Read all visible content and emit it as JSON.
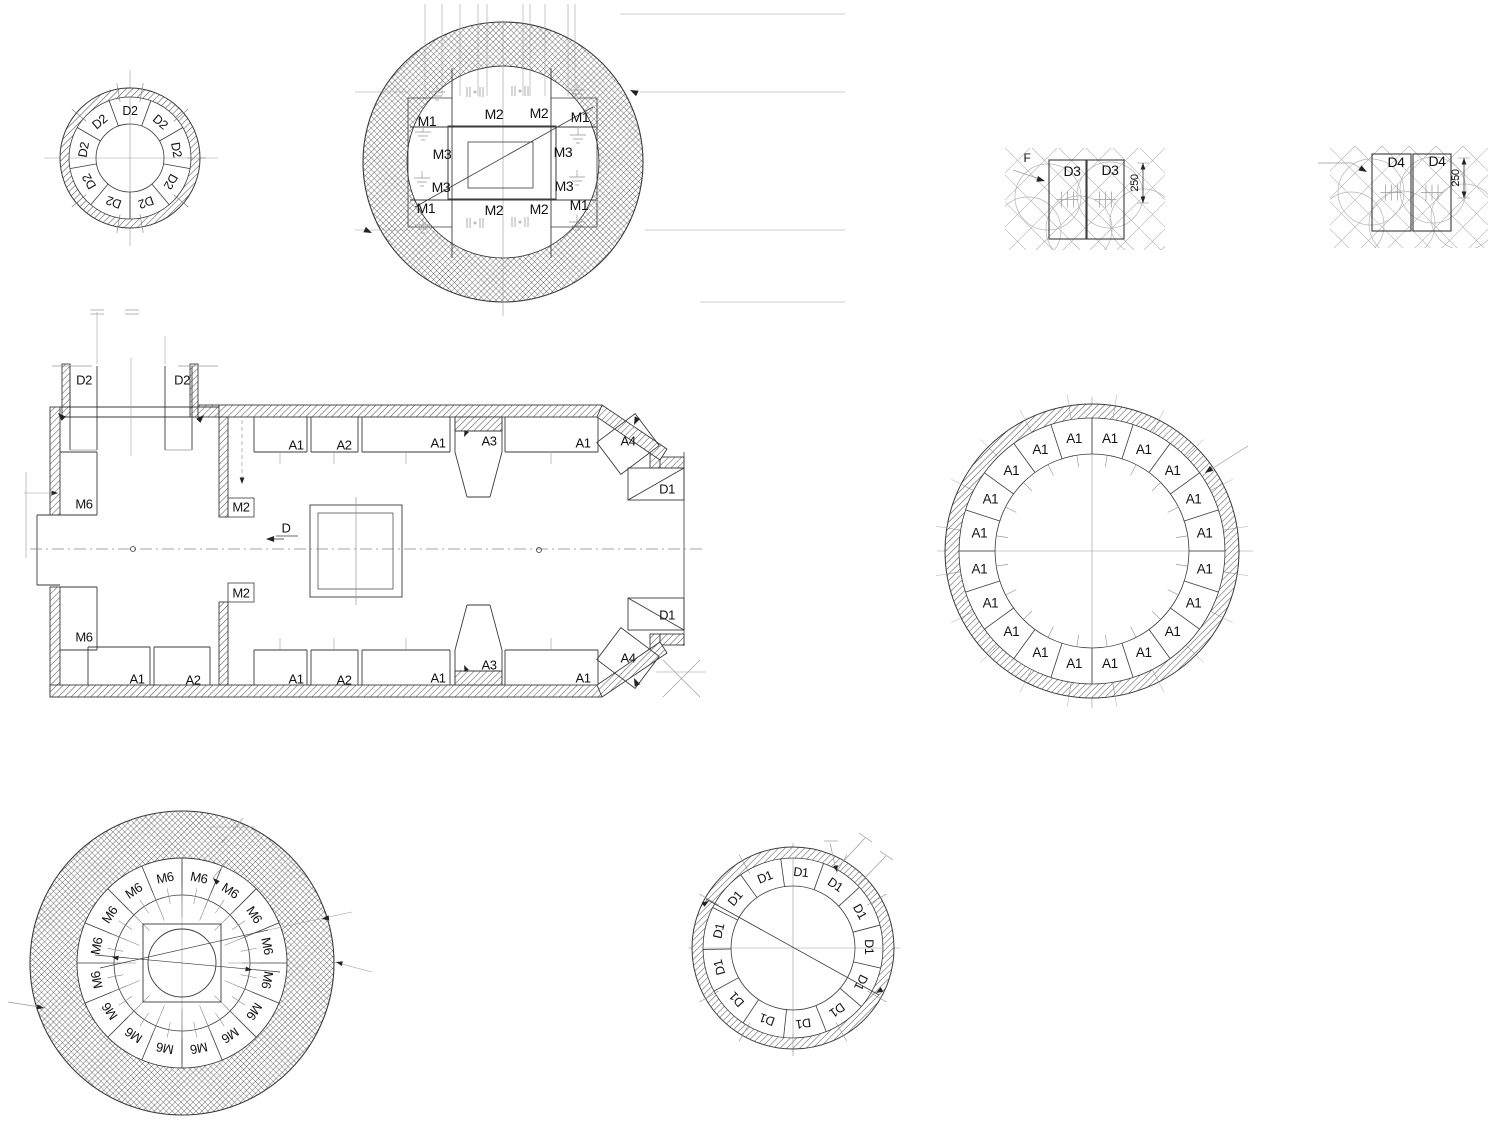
{
  "drawing": {
    "colors": {
      "line": "#3a3a3a",
      "gray": "#999999",
      "hatch": "#4a4a4a",
      "text": "#111111"
    },
    "rings": {
      "d2": {
        "label": "D2",
        "count": 9
      },
      "a1": {
        "label": "A1",
        "count": 20
      },
      "m6": {
        "label": "M6",
        "count": 16
      },
      "d1": {
        "label": "D1",
        "count": 13
      }
    },
    "m_section": {
      "labels": [
        {
          "t": "M1",
          "x": 427,
          "y": 121
        },
        {
          "t": "M2",
          "x": 494,
          "y": 114
        },
        {
          "t": "M2",
          "x": 539,
          "y": 113
        },
        {
          "t": "M1",
          "x": 580,
          "y": 117
        },
        {
          "t": "M3",
          "x": 442,
          "y": 154
        },
        {
          "t": "M3",
          "x": 563,
          "y": 152
        },
        {
          "t": "M3",
          "x": 441,
          "y": 187
        },
        {
          "t": "M3",
          "x": 564,
          "y": 186
        },
        {
          "t": "M1",
          "x": 426,
          "y": 208
        },
        {
          "t": "M2",
          "x": 494,
          "y": 210
        },
        {
          "t": "M2",
          "x": 539,
          "y": 209
        },
        {
          "t": "M1",
          "x": 579,
          "y": 205
        }
      ]
    },
    "pile_details": [
      {
        "id": "d3",
        "cells": [
          "D3",
          "D3"
        ],
        "marker": "F",
        "dim": "250"
      },
      {
        "id": "d4",
        "cells": [
          "D4",
          "D4"
        ],
        "marker": "",
        "dim": "250"
      }
    ],
    "plan": {
      "section_marker": "D",
      "labels": [
        {
          "t": "D2",
          "x": 84,
          "y": 380
        },
        {
          "t": "D2",
          "x": 182,
          "y": 380
        },
        {
          "t": "M6",
          "x": 84,
          "y": 504
        },
        {
          "t": "M6",
          "x": 84,
          "y": 637
        },
        {
          "t": "M2",
          "x": 241,
          "y": 507
        },
        {
          "t": "M2",
          "x": 241,
          "y": 593
        },
        {
          "t": "A1",
          "x": 296,
          "y": 445
        },
        {
          "t": "A2",
          "x": 344,
          "y": 445
        },
        {
          "t": "A1",
          "x": 438,
          "y": 443
        },
        {
          "t": "A3",
          "x": 489,
          "y": 441
        },
        {
          "t": "A1",
          "x": 583,
          "y": 443
        },
        {
          "t": "A4",
          "x": 628,
          "y": 441
        },
        {
          "t": "D1",
          "x": 667,
          "y": 489
        },
        {
          "t": "D1",
          "x": 667,
          "y": 615
        },
        {
          "t": "A1",
          "x": 137,
          "y": 679
        },
        {
          "t": "A2",
          "x": 193,
          "y": 680
        },
        {
          "t": "A1",
          "x": 296,
          "y": 679
        },
        {
          "t": "A2",
          "x": 344,
          "y": 680
        },
        {
          "t": "A1",
          "x": 438,
          "y": 678
        },
        {
          "t": "A3",
          "x": 489,
          "y": 665
        },
        {
          "t": "A1",
          "x": 583,
          "y": 678
        },
        {
          "t": "A4",
          "x": 628,
          "y": 658
        }
      ]
    }
  }
}
